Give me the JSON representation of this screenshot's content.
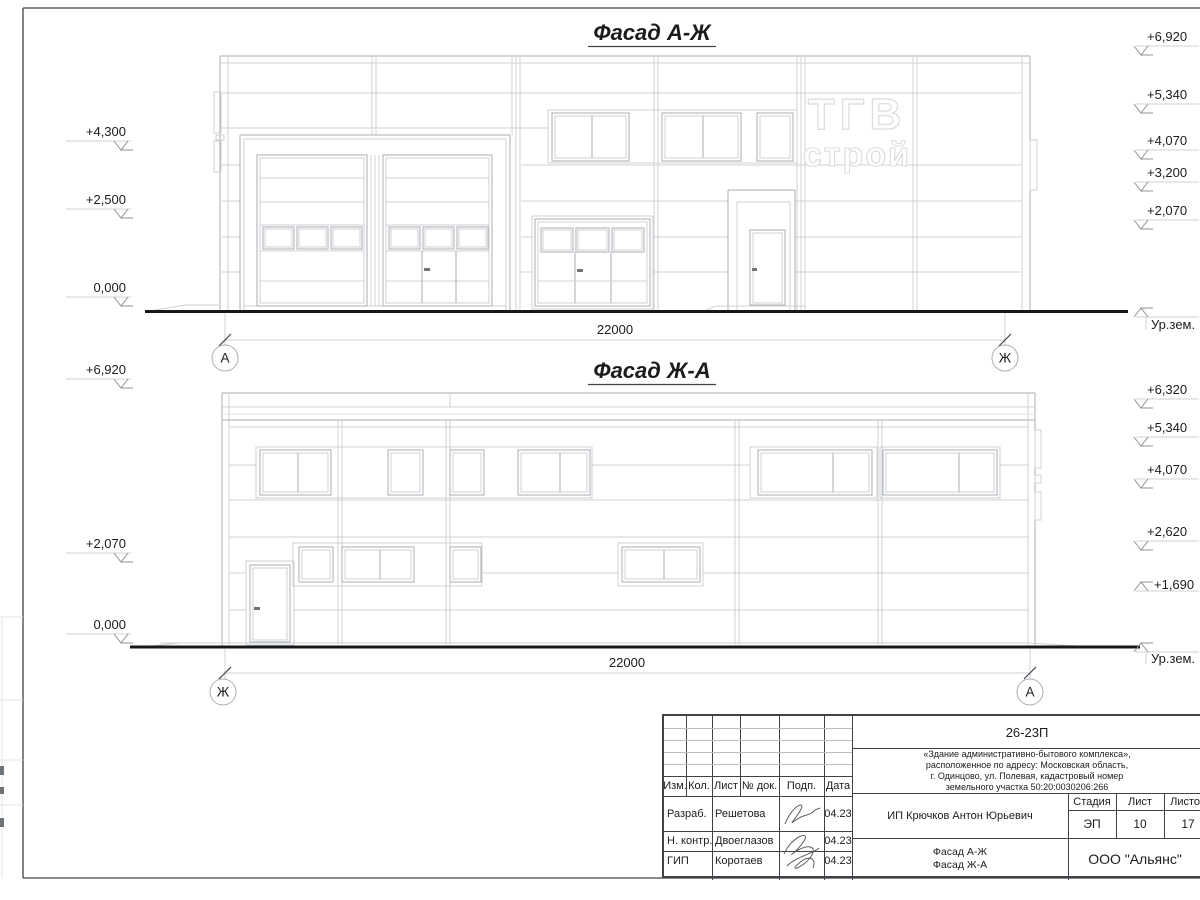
{
  "colors": {
    "ink": "#1b1c1e",
    "line_light": "#ccd0d3",
    "line_medium": "#a9aeb3",
    "line_dark": "#3f4347",
    "ground_line": "#17181a",
    "logo_outline": "#dadcde",
    "background": "#ffffff"
  },
  "facades": [
    {
      "title": "Фасад А-Ж",
      "dimension": "22000",
      "axis_left": "А",
      "axis_right": "Ж",
      "ground_label": "Ур.зем.",
      "elev_left": [
        "+4,300",
        "+2,500",
        "0,000"
      ],
      "elev_right": [
        "+6,920",
        "+5,340",
        "+4,070",
        "+3,200",
        "+2,070"
      ]
    },
    {
      "title": "Фасад Ж-А",
      "dimension": "22000",
      "axis_left": "Ж",
      "axis_right": "А",
      "ground_label": "Ур.зем.",
      "elev_left": [
        "+6,920",
        "+2,070",
        "0,000"
      ],
      "elev_right": [
        "+6,320",
        "+5,340",
        "+4,070",
        "+2,620",
        "+1,690"
      ]
    }
  ],
  "logo": {
    "line1": "ТГВ",
    "line2": "строй"
  },
  "title_block": {
    "doc_number": "26-23П",
    "project_description": "«Здание административно-бытового комплекса»,\nрасположенное по адресу: Московская область,\nг. Одинцово, ул. Полевая, кадастровый номер\nземельного участка 50:20:0030206:266",
    "columns": {
      "izm": "Изм.",
      "kol": "Кол.",
      "list": "Лист",
      "doc": "№ док.",
      "podp": "Подп.",
      "data": "Дата"
    },
    "rows": [
      {
        "role": "Разраб.",
        "name": "Решетова",
        "date": "04.23"
      },
      {
        "role": "Н. контр.",
        "name": "Двоеглазов",
        "date": "04.23"
      },
      {
        "role": "ГИП",
        "name": "Коротаев",
        "date": "04.23"
      }
    ],
    "client": "ИП Крючков Антон Юрьевич",
    "stage_label": "Стадия",
    "sheet_label": "Лист",
    "sheets_label": "Листов",
    "stage": "ЭП",
    "sheet_number": "10",
    "sheets_total": "17",
    "sheet_title": "Фасад А-Ж\nФасад Ж-А",
    "organization": "ООО \"Альянс\""
  }
}
